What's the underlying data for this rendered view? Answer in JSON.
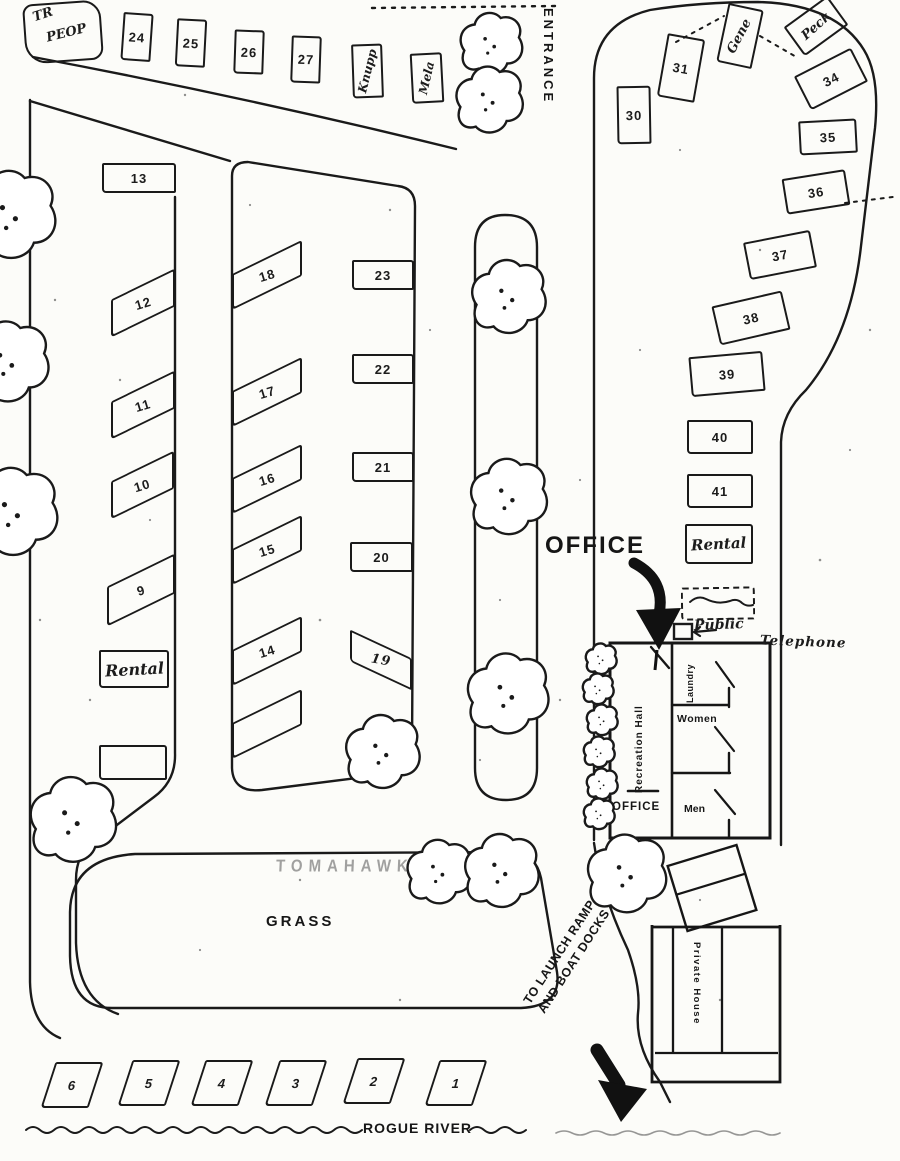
{
  "paper_color": "#fcfcf9",
  "ink_color": "#1a1a1a",
  "labels": {
    "entrance": "ENTRANCE",
    "office_big": "OFFICE",
    "grass": "GRASS",
    "faded_area_text": "TOMAHAWK",
    "rogue_river": "ROGUE RIVER",
    "launch_line1": "TO LAUNCH RAMP",
    "launch_line2": "AND BOAT DOCKS",
    "public": "Public",
    "telephone": "Telephone"
  },
  "building": {
    "recreation_hall": "Recreation Hall",
    "office": "OFFICE",
    "laundry": "Laundry",
    "women": "Women",
    "men": "Men"
  },
  "private_house_label": "Private House",
  "handwritten": {
    "note_line1": "TR",
    "note_line2": "PEOP",
    "camper1": "Knupp",
    "camper2": "Mela",
    "camper3": "Gene",
    "camper4": "Peck",
    "rental_left": "Rental",
    "rental_right": "Rental"
  },
  "sites": {
    "1": "1",
    "2": "2",
    "3": "3",
    "4": "4",
    "5": "5",
    "6": "6",
    "9": "9",
    "10": "10",
    "11": "11",
    "12": "12",
    "13": "13",
    "14": "14",
    "15": "15",
    "16": "16",
    "17": "17",
    "18": "18",
    "19": "19",
    "20": "20",
    "21": "21",
    "22": "22",
    "23": "23",
    "24": "24",
    "25": "25",
    "26": "26",
    "27": "27",
    "30": "30",
    "31": "31",
    "34": "34",
    "35": "35",
    "36": "36",
    "37": "37",
    "38": "38",
    "39": "39",
    "40": "40",
    "41": "41"
  }
}
